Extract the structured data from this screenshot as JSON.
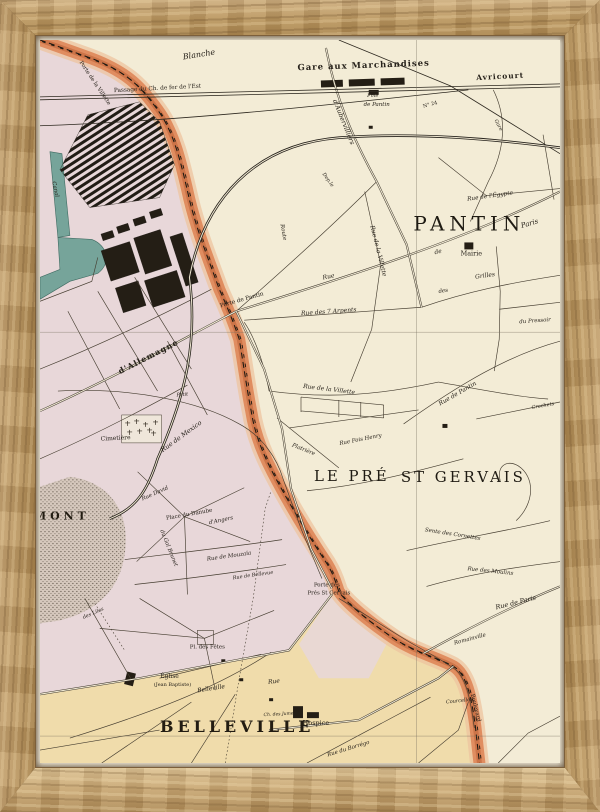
{
  "colors": {
    "cream": "#f3ecd6",
    "paris_pink": "#e8d7d9",
    "belleville_tan": "#f0dcab",
    "fort_orange": "#df8a5d",
    "fort_dark": "#bc6134",
    "fort_glacis": "#eec49f",
    "canal": "#76a49a",
    "canal_dark": "#3f6b62",
    "park": "#d6c8bd",
    "ink": "#26211a",
    "frame_wood": "#b8955f"
  },
  "map": {
    "labels": [
      {
        "t": "Blanche",
        "x": 160,
        "y": 17,
        "r": -9,
        "c": "street",
        "s": 8
      },
      {
        "t": "Gare aux Marchandises",
        "x": 325,
        "y": 28,
        "r": -2,
        "c": "place",
        "s": 8.5
      },
      {
        "t": "Avricourt",
        "x": 462,
        "y": 39,
        "r": -3,
        "c": "place",
        "s": 7.5
      },
      {
        "t": "Passage du Ch. de fer de l'Est",
        "x": 118,
        "y": 50,
        "r": -3,
        "c": "plain",
        "s": 5.8
      },
      {
        "t": "Fme",
        "x": 334,
        "y": 57,
        "r": 0,
        "c": "street",
        "s": 5
      },
      {
        "t": "de Pantin",
        "x": 338,
        "y": 66,
        "r": 0,
        "c": "street",
        "s": 5.5
      },
      {
        "t": "d'Aubervilliers",
        "x": 303,
        "y": 83,
        "r": 68,
        "c": "street",
        "s": 6.5
      },
      {
        "t": "N° 24",
        "x": 392,
        "y": 66,
        "r": -15,
        "c": "plain",
        "s": 5
      },
      {
        "t": "Gare",
        "x": 459,
        "y": 86,
        "r": 62,
        "c": "street",
        "s": 5
      },
      {
        "t": "Rue de l'Égypte",
        "x": 452,
        "y": 158,
        "r": -8,
        "c": "street",
        "s": 5.8
      },
      {
        "t": "PANTIN",
        "x": 431,
        "y": 191,
        "r": 0,
        "c": "city"
      },
      {
        "t": "Mairie",
        "x": 433,
        "y": 216,
        "r": 0,
        "c": "plain",
        "s": 6.5
      },
      {
        "t": "Rue",
        "x": 290,
        "y": 239,
        "r": -11,
        "c": "street",
        "s": 6
      },
      {
        "t": "de",
        "x": 400,
        "y": 214,
        "r": -13,
        "c": "street",
        "s": 6
      },
      {
        "t": "Paris",
        "x": 492,
        "y": 186,
        "r": -16,
        "c": "street",
        "s": 7
      },
      {
        "t": "des",
        "x": 405,
        "y": 253,
        "r": -8,
        "c": "street",
        "s": 5.5
      },
      {
        "t": "Grilles",
        "x": 447,
        "y": 238,
        "r": -8,
        "c": "street",
        "s": 6
      },
      {
        "t": "du Pressoir",
        "x": 497,
        "y": 283,
        "r": -4,
        "c": "street",
        "s": 5.5
      },
      {
        "t": "Rue des 7 Arpents",
        "x": 290,
        "y": 274,
        "r": -4,
        "c": "street",
        "s": 6
      },
      {
        "t": "Rue de la Villette",
        "x": 338,
        "y": 212,
        "r": 76,
        "c": "street",
        "s": 6
      },
      {
        "t": "Route",
        "x": 243,
        "y": 193,
        "r": 80,
        "c": "street",
        "s": 5.5
      },
      {
        "t": "Dep.le",
        "x": 288,
        "y": 141,
        "r": 55,
        "c": "street",
        "s": 5
      },
      {
        "t": "Porte de la Villette",
        "x": 54,
        "y": 44,
        "r": 56,
        "c": "porte"
      },
      {
        "t": "Porte de Pantin",
        "x": 203,
        "y": 262,
        "r": -16,
        "c": "porte",
        "s": 5.8
      },
      {
        "t": "d'Allemagne",
        "x": 110,
        "y": 320,
        "r": -27,
        "c": "place",
        "s": 8
      },
      {
        "t": "Canal",
        "x": 14,
        "y": 150,
        "r": 78,
        "c": "street",
        "s": 5.5
      },
      {
        "t": "Petit",
        "x": 143,
        "y": 357,
        "r": -5,
        "c": "street",
        "s": 5
      },
      {
        "t": "Rue de Pantin",
        "x": 420,
        "y": 356,
        "r": -30,
        "c": "street",
        "s": 6
      },
      {
        "t": "Crochets",
        "x": 505,
        "y": 368,
        "r": -10,
        "c": "street",
        "s": 5
      },
      {
        "t": "Rue de la Villette",
        "x": 290,
        "y": 352,
        "r": 7,
        "c": "street",
        "s": 6
      },
      {
        "t": "Rue Fois Henry",
        "x": 322,
        "y": 402,
        "r": -11,
        "c": "street",
        "s": 5.5
      },
      {
        "t": "Platrière",
        "x": 264,
        "y": 412,
        "r": 22,
        "c": "street",
        "s": 5.5
      },
      {
        "t": "LE PRÉ",
        "x": 313,
        "y": 442,
        "r": 0,
        "c": "city2"
      },
      {
        "t": "ST GERVAIS",
        "x": 425,
        "y": 443,
        "r": 0,
        "c": "city2"
      },
      {
        "t": "Sente des Cornettes",
        "x": 414,
        "y": 497,
        "r": 9,
        "c": "street",
        "s": 5.5
      },
      {
        "t": "Rue des Moulins",
        "x": 452,
        "y": 534,
        "r": 6,
        "c": "street",
        "s": 5.5
      },
      {
        "t": "Rue de Paris",
        "x": 478,
        "y": 566,
        "r": -14,
        "c": "street",
        "s": 6.5
      },
      {
        "t": "Porte des",
        "x": 288,
        "y": 548,
        "r": 0,
        "c": "porte"
      },
      {
        "t": "Prés St Gervais",
        "x": 290,
        "y": 556,
        "r": 0,
        "c": "porte"
      },
      {
        "t": "Romainville",
        "x": 432,
        "y": 602,
        "r": -15,
        "c": "street",
        "s": 5.5
      },
      {
        "t": "Boulevard",
        "x": 436,
        "y": 670,
        "r": 76,
        "c": "porte"
      },
      {
        "t": "Cimetière",
        "x": 76,
        "y": 401,
        "r": -3,
        "c": "plain",
        "s": 6
      },
      {
        "t": "Rue de Mexico",
        "x": 143,
        "y": 399,
        "r": -36,
        "c": "street",
        "s": 6.5
      },
      {
        "t": "Place du Danube",
        "x": 150,
        "y": 477,
        "r": -10,
        "c": "plain",
        "s": 5.5
      },
      {
        "t": "du Gal Brunet",
        "x": 128,
        "y": 510,
        "r": 68,
        "c": "street",
        "s": 5.5
      },
      {
        "t": "Rue David",
        "x": 116,
        "y": 456,
        "r": -24,
        "c": "street",
        "s": 5.5
      },
      {
        "t": "d'Angers",
        "x": 182,
        "y": 483,
        "r": -12,
        "c": "street",
        "s": 5.5
      },
      {
        "t": "Rue de Mouzaïa",
        "x": 190,
        "y": 519,
        "r": -8,
        "c": "street",
        "s": 5.5
      },
      {
        "t": "Rue de Bellevue",
        "x": 214,
        "y": 538,
        "r": -8,
        "c": "street",
        "s": 5
      },
      {
        "t": "MONT",
        "x": 22,
        "y": 481,
        "r": 0,
        "c": "slab",
        "s": 11
      },
      {
        "t": "des Lilas",
        "x": 54,
        "y": 576,
        "r": -24,
        "c": "street",
        "s": 5
      },
      {
        "t": "Pl. des Fêtes",
        "x": 168,
        "y": 610,
        "r": 0,
        "c": "plain",
        "s": 5.5
      },
      {
        "t": "Église",
        "x": 130,
        "y": 640,
        "r": 0,
        "c": "plain",
        "s": 6
      },
      {
        "t": "(Jean Baptiste)",
        "x": 133,
        "y": 648,
        "r": 0,
        "c": "plain",
        "s": 5
      },
      {
        "t": "Belleville",
        "x": 172,
        "y": 652,
        "r": -9,
        "c": "street",
        "s": 6
      },
      {
        "t": "Rue",
        "x": 235,
        "y": 645,
        "r": -7,
        "c": "street",
        "s": 6
      },
      {
        "t": "BELLEVILLE",
        "x": 198,
        "y": 694,
        "r": 0,
        "c": "slab"
      },
      {
        "t": "Hospice",
        "x": 277,
        "y": 687,
        "r": 0,
        "c": "plain",
        "s": 6.5
      },
      {
        "t": "Ch. des Juments",
        "x": 243,
        "y": 677,
        "r": -3,
        "c": "street",
        "s": 4.5
      },
      {
        "t": "Rue du Borrégo",
        "x": 310,
        "y": 712,
        "r": -17,
        "c": "street",
        "s": 5.5
      },
      {
        "t": "Courcelles",
        "x": 421,
        "y": 664,
        "r": -6,
        "c": "street",
        "s": 5
      }
    ]
  }
}
